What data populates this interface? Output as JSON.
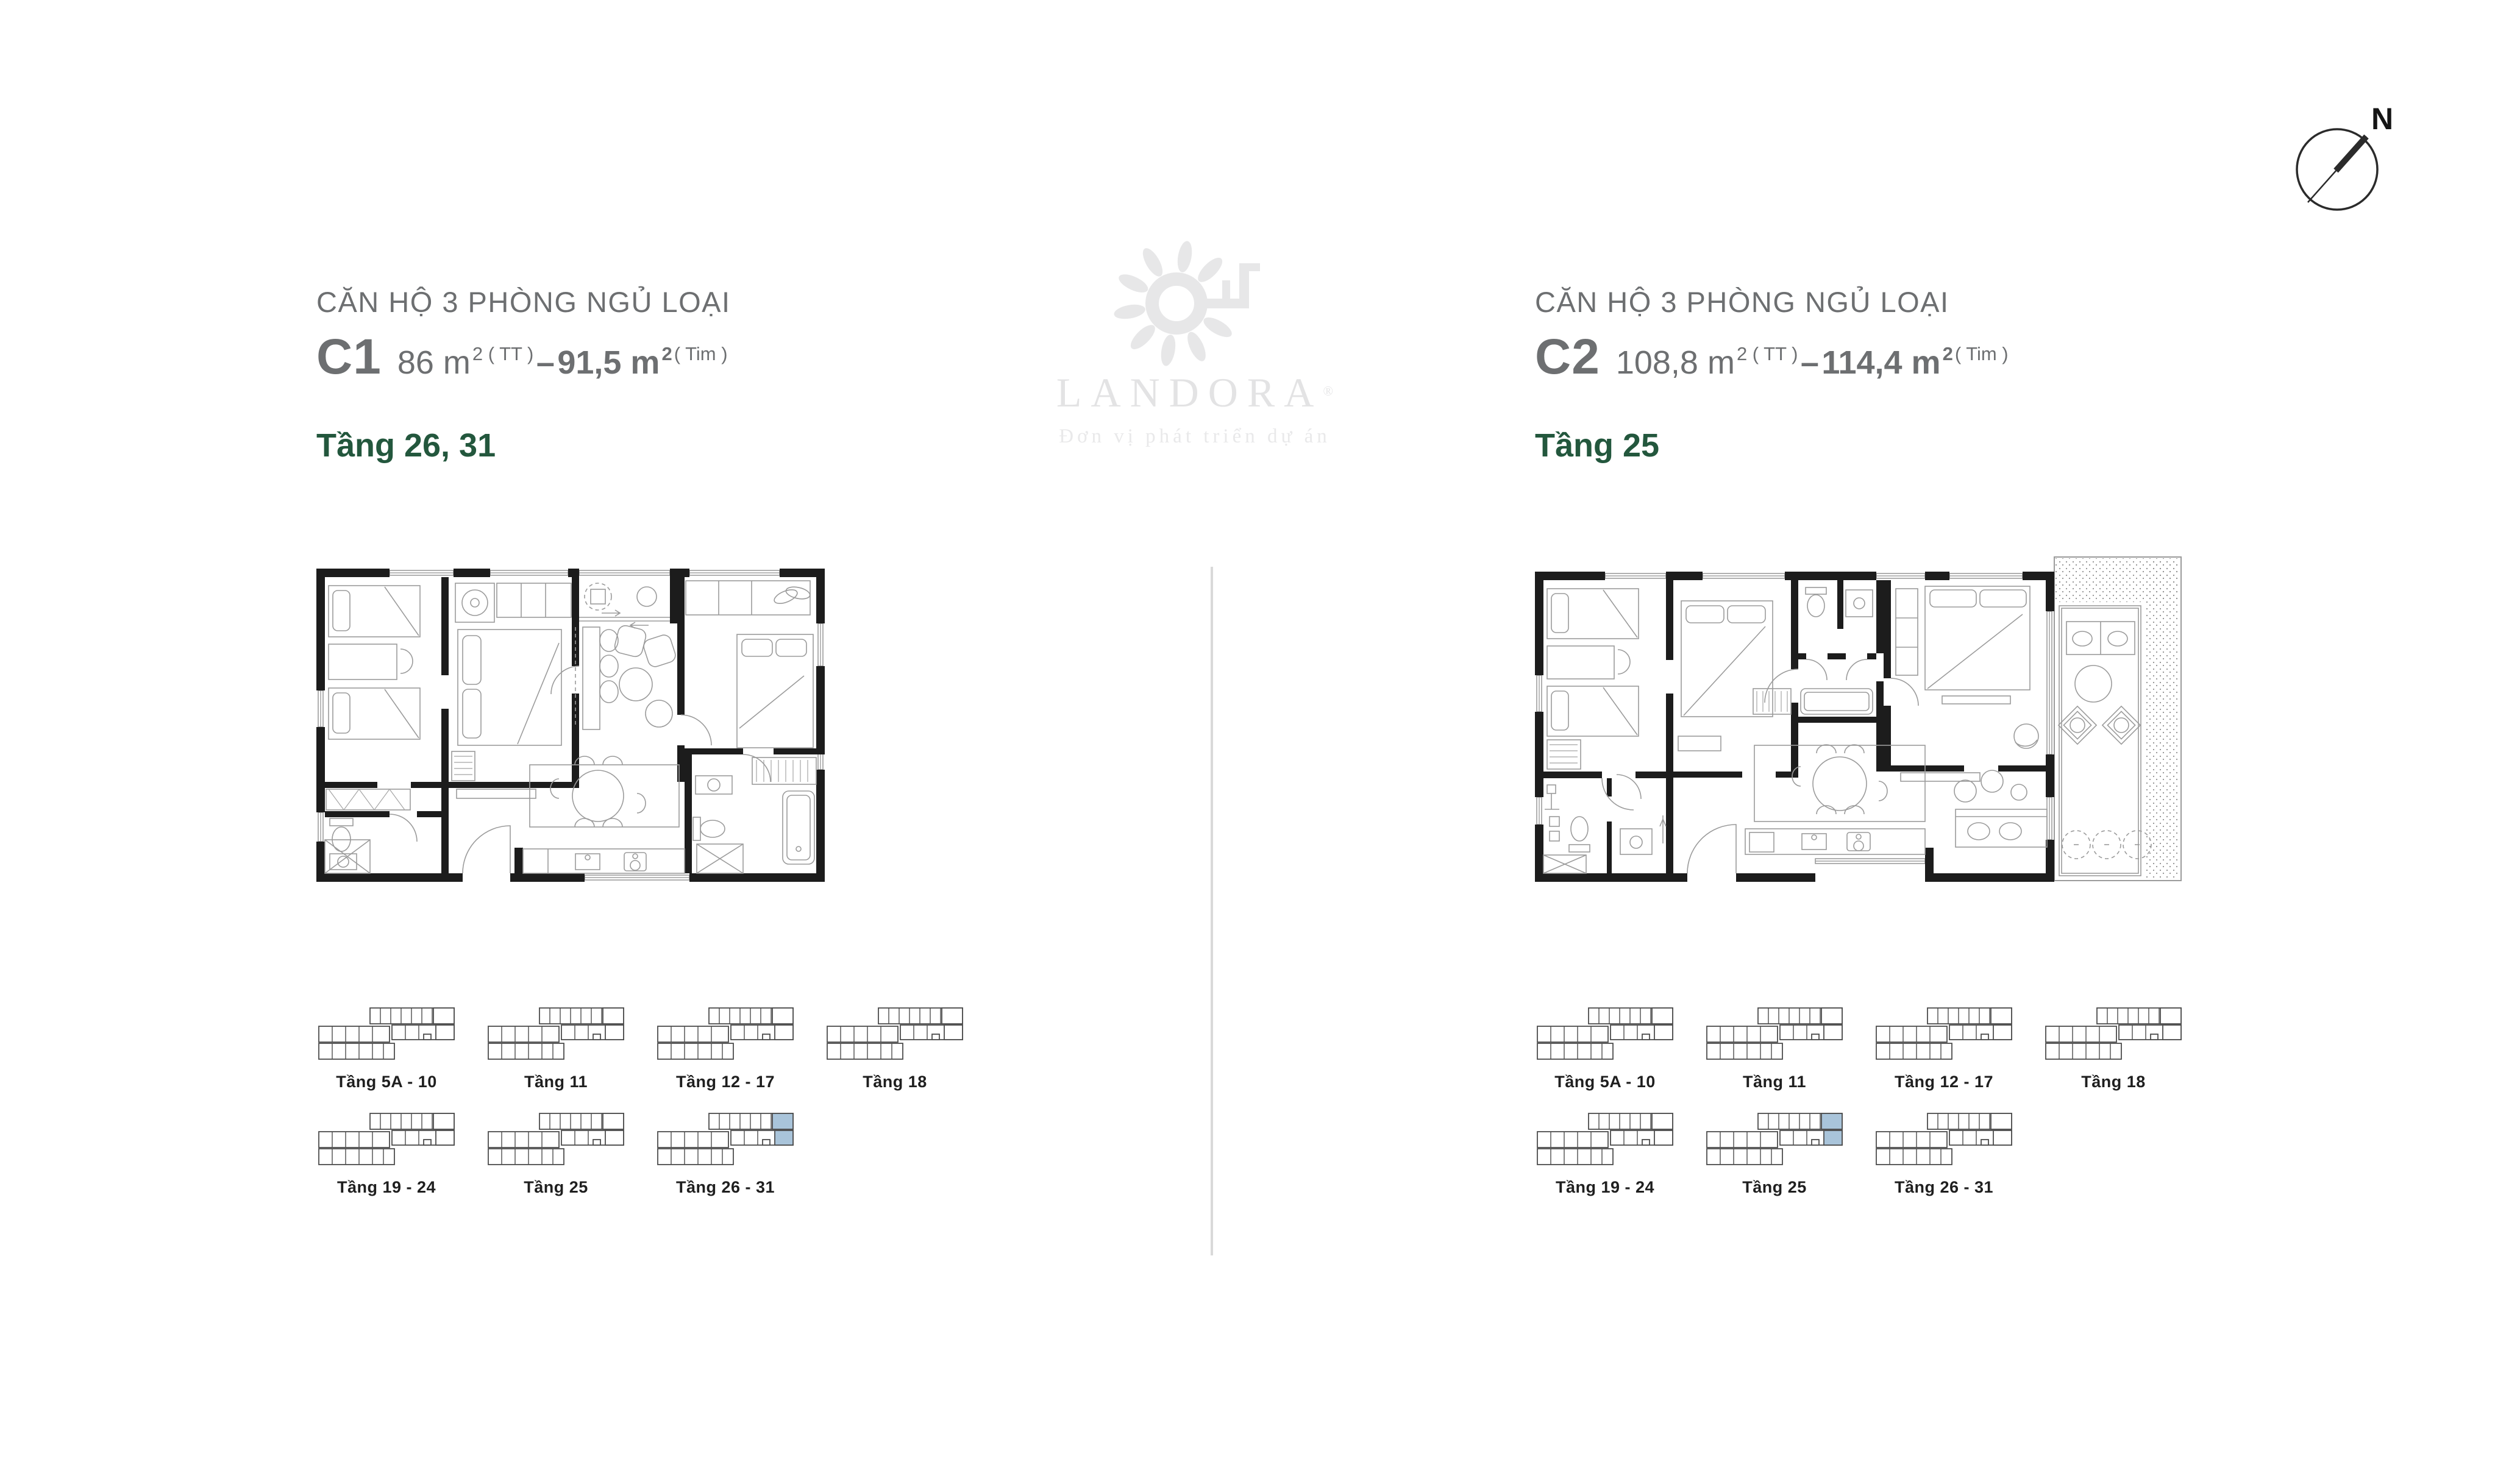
{
  "colors": {
    "accent_green": "#23573d",
    "heading_gray": "#6d6f71",
    "keyplan_highlight_blue": "#a9c4da",
    "wall_black": "#1c1c1c",
    "watermark_gray": "#e6e6e7"
  },
  "compass": {
    "label": "N"
  },
  "watermark": {
    "brand": "LANDORA",
    "registered": "®",
    "tagline": "Đơn vị phát triển dự án"
  },
  "units": {
    "c1": {
      "category": "CĂN HỘ 3 PHÒNG NGỦ LOẠI",
      "code": "C1",
      "area_primary": "86 m",
      "area_primary_sup": "2 ( TT )",
      "separator": "–",
      "area_secondary": "91,5 m",
      "area_secondary_sup": "2",
      "area_secondary_note": "( Tim )",
      "floors": "Tầng 26, 31",
      "keyplans": [
        {
          "label": "Tầng 5A - 10",
          "highlighted": false
        },
        {
          "label": "Tầng 11",
          "highlighted": false
        },
        {
          "label": "Tầng 12 - 17",
          "highlighted": false
        },
        {
          "label": "Tầng 18",
          "highlighted": false
        },
        {
          "label": "Tầng 19 - 24",
          "highlighted": false
        },
        {
          "label": "Tầng 25",
          "highlighted": false
        },
        {
          "label": "Tầng 26 - 31",
          "highlighted": true
        }
      ]
    },
    "c2": {
      "category": "CĂN HỘ 3 PHÒNG NGỦ LOẠI",
      "code": "C2",
      "area_primary": "108,8 m",
      "area_primary_sup": "2 ( TT )",
      "separator": "–",
      "area_secondary": "114,4 m",
      "area_secondary_sup": "2",
      "area_secondary_note": "( Tim )",
      "floors": "Tầng 25",
      "keyplans": [
        {
          "label": "Tầng 5A - 10",
          "highlighted": false
        },
        {
          "label": "Tầng 11",
          "highlighted": false
        },
        {
          "label": "Tầng 12 - 17",
          "highlighted": false
        },
        {
          "label": "Tầng 18",
          "highlighted": false
        },
        {
          "label": "Tầng 19 - 24",
          "highlighted": false
        },
        {
          "label": "Tầng 25",
          "highlighted": true
        },
        {
          "label": "Tầng 26 - 31",
          "highlighted": false
        }
      ]
    }
  }
}
